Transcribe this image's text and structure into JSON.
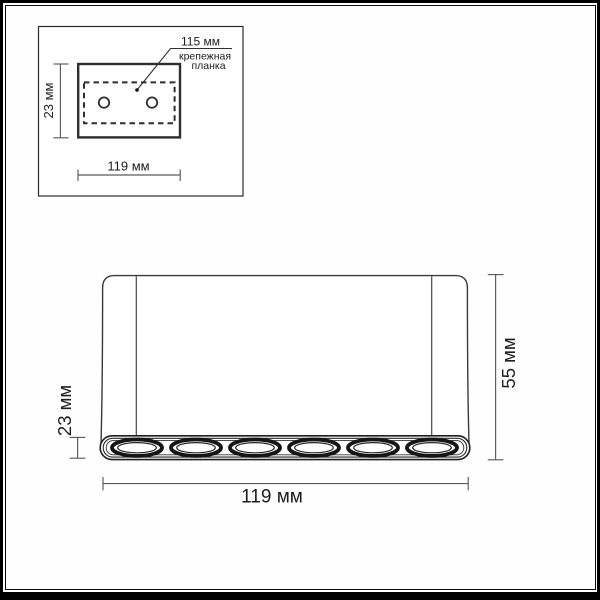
{
  "colors": {
    "line": "#2e2e2e",
    "dim_line": "#5b5b5b",
    "text": "#1d1d1d",
    "background": "#fefefe",
    "frame": "#000000"
  },
  "inset_view": {
    "dim_height": "23 мм",
    "dim_width": "119 мм",
    "plate_dim": "115 мм",
    "plate_label_line1": "крепежная",
    "plate_label_line2": "планка",
    "hole_count": 2
  },
  "front_view": {
    "dim_depth": "23 мм",
    "dim_height": "55 мм",
    "dim_width": "119 мм",
    "led_count": 6
  }
}
